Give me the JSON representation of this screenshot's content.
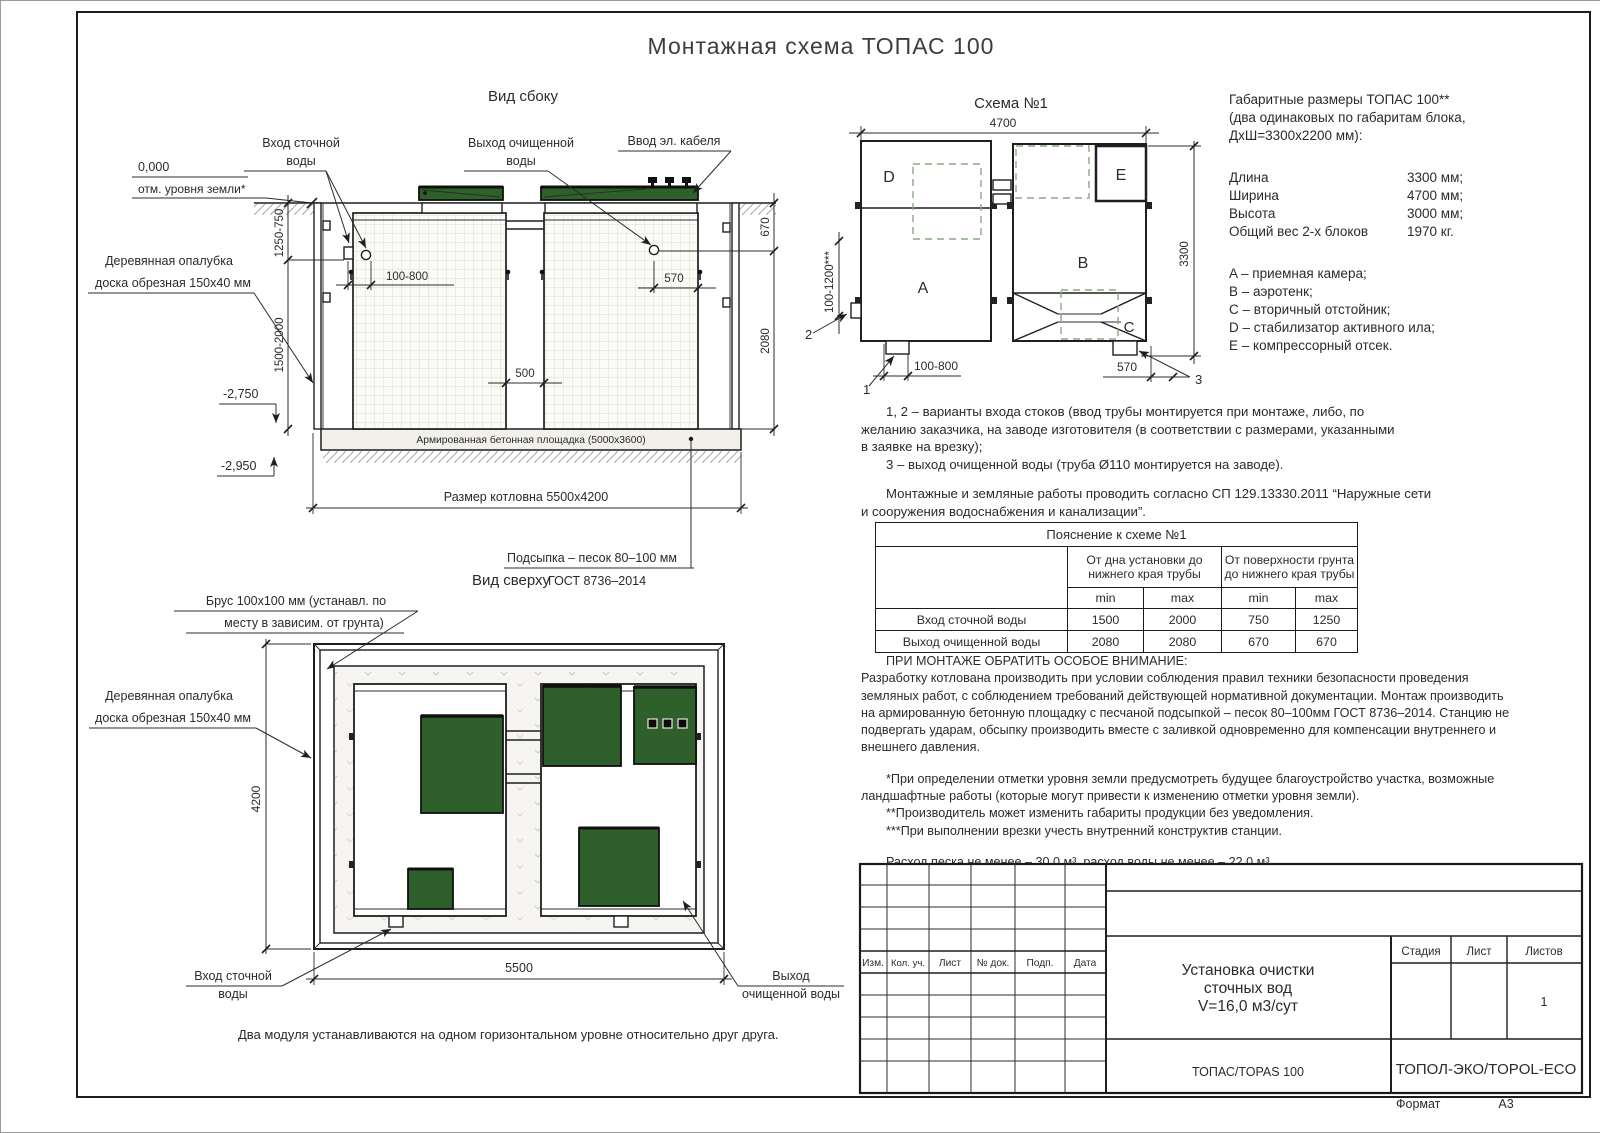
{
  "sheet": {
    "title": "Монтажная схема ТОПАС 100",
    "format_label": "Формат",
    "format_value": "А3"
  },
  "colors": {
    "green": "#2f5f2a",
    "dashed_green": "#8aa883",
    "line": "#1f1f1f"
  },
  "side_view": {
    "title": "Вид сбоку",
    "zero_mark": "0,000",
    "ground_label": "отм. уровня земли*",
    "inlet_label_1": "Вход сточной",
    "inlet_label_2": "воды",
    "outlet_label_1": "Выход очищенной",
    "outlet_label_2": "воды",
    "cable_label": "Ввод эл. кабеля",
    "formwork_label_1": "Деревянная опалубка",
    "formwork_label_2": "доска обрезная 150х40 мм",
    "pad_label": "Армированная бетонная площадка (5000х3600)",
    "pit_label": "Размер котловна 5500х4200",
    "bedding_label_1": "Подсыпка – песок 80–100 мм",
    "bedding_label_2": "ГОСТ 8736–2014",
    "dim_depth_upper": "1250-750",
    "dim_depth_lower": "1500-2000",
    "dim_inlet": "100-800",
    "dim_gap": "500",
    "dim_outlet": "570",
    "dim_right_upper": "670",
    "dim_right_lower": "2080",
    "elev_1": "-2,750",
    "elev_2": "-2,950"
  },
  "schema": {
    "title": "Схема №1",
    "dim_width": "4700",
    "dim_height": "3300",
    "dim_inlet_range": "100-1200***",
    "dim_bottom_left": "100-800",
    "dim_bottom_right": "570",
    "A": "A",
    "B": "B",
    "C": "C",
    "D": "D",
    "E": "E",
    "callout_1": "1",
    "callout_2": "2",
    "callout_3": "3"
  },
  "specs": {
    "heading_1": "Габаритные размеры ТОПАС 100**",
    "heading_2": "(два одинаковых по габаритам блока,",
    "heading_3": "ДхШ=3300х2200 мм):",
    "rows": [
      {
        "label": "Длина",
        "value": "3300 мм;"
      },
      {
        "label": "Ширина",
        "value": "4700 мм;"
      },
      {
        "label": "Высота",
        "value": "3000 мм;"
      },
      {
        "label": "Общий вес 2-х блоков",
        "value": "1970 кг."
      }
    ],
    "legend": [
      "A – приемная камера;",
      "B – аэротенк;",
      "C – вторичный отстойник;",
      "D – стабилизатор активного ила;",
      "E – компрессорный отсек."
    ]
  },
  "notes": {
    "p1_l1": "1, 2 – варианты входа  стоков (ввод трубы монтируется при монтаже, либо, по",
    "p1_l2": "желанию заказчика, на заводе изготовителя (в соответствии с размерами, указанными",
    "p1_l3": "в заявке на врезку);",
    "p2": "3 – выход очищенной воды (труба Ø110 монтируется на заводе).",
    "p3_l1": "Монтажные и земляные работы проводить согласно СП 129.13330.2011 “Наружные сети",
    "p3_l2": "и сооружения водоснабжения и канализации”."
  },
  "table": {
    "title": "Пояснение к схеме №1",
    "group1_l1": "От дна установки до",
    "group1_l2": "нижнего края трубы",
    "group2_l1": "От поверхности грунта",
    "group2_l2": "до нижнего края трубы",
    "min": "min",
    "max": "max",
    "rows": [
      {
        "label": "Вход сточной воды",
        "v1": "1500",
        "v2": "2000",
        "v3": "750",
        "v4": "1250"
      },
      {
        "label": "Выход очищенной воды",
        "v1": "2080",
        "v2": "2080",
        "v3": "670",
        "v4": "670"
      }
    ]
  },
  "attention": {
    "heading": "ПРИ МОНТАЖЕ ОБРАТИТЬ ОСОБОЕ ВНИМАНИЕ:",
    "l1": "Разработку котлована производить при условии соблюдения правил техники безопасности проведения",
    "l2": "земляных работ, с соблюдением требований действующей нормативной документации.  Монтаж производить",
    "l3": "на армированную бетонную площадку с песчаной подсыпкой – песок 80–100мм ГОСТ 8736–2014. Станцию не",
    "l4": "подвергать ударам, обсыпку производить вместе с заливкой одновременно для компенсации внутреннего и",
    "l5": "внешнего давления.",
    "star1_l1": "*При определении отметки уровня земли предусмотреть будущее благоустройство участка, возможные",
    "star1_l2": "ландшафтные работы (которые могут привести к изменению отметки уровня земли).",
    "star2": "**Производитель может изменить габариты продукции без уведомления.",
    "star3": "***При выполнении врезки учесть внутренний конструктив станции.",
    "consumption": "Расход песка не менее – 30,0 м³, расход воды не менее – 22,0 м³."
  },
  "top_view": {
    "title": "Вид сверху",
    "beam_label_1": "Брус 100х100 мм (устанавл. по",
    "beam_label_2": "месту в зависим. от грунта)",
    "formwork_label_1": "Деревянная опалубка",
    "formwork_label_2": "доска обрезная 150х40 мм",
    "dim_height": "4200",
    "dim_width": "5500",
    "inlet_label_1": "Вход сточной",
    "inlet_label_2": "воды",
    "outlet_label_1": "Выход",
    "outlet_label_2": "очищенной воды",
    "note": "Два модуля устанавливаются на одном горизонтальном уровне относительно друг друга."
  },
  "title_block": {
    "rev_headers": [
      "Изм.",
      "Кол. уч.",
      "Лист",
      "№ док.",
      "Подп.",
      "Дата"
    ],
    "doc_1": "Установка очистки",
    "doc_2": "сточных вод",
    "doc_3": "V=16,0 м3/сут",
    "stage_label": "Стадия",
    "sheet_label": "Лист",
    "sheets_label": "Листов",
    "sheets_value": "1",
    "product": "ТОПАС/TOPAS 100",
    "company": "ТОПОЛ-ЭКО/TOPOL-ECO"
  }
}
